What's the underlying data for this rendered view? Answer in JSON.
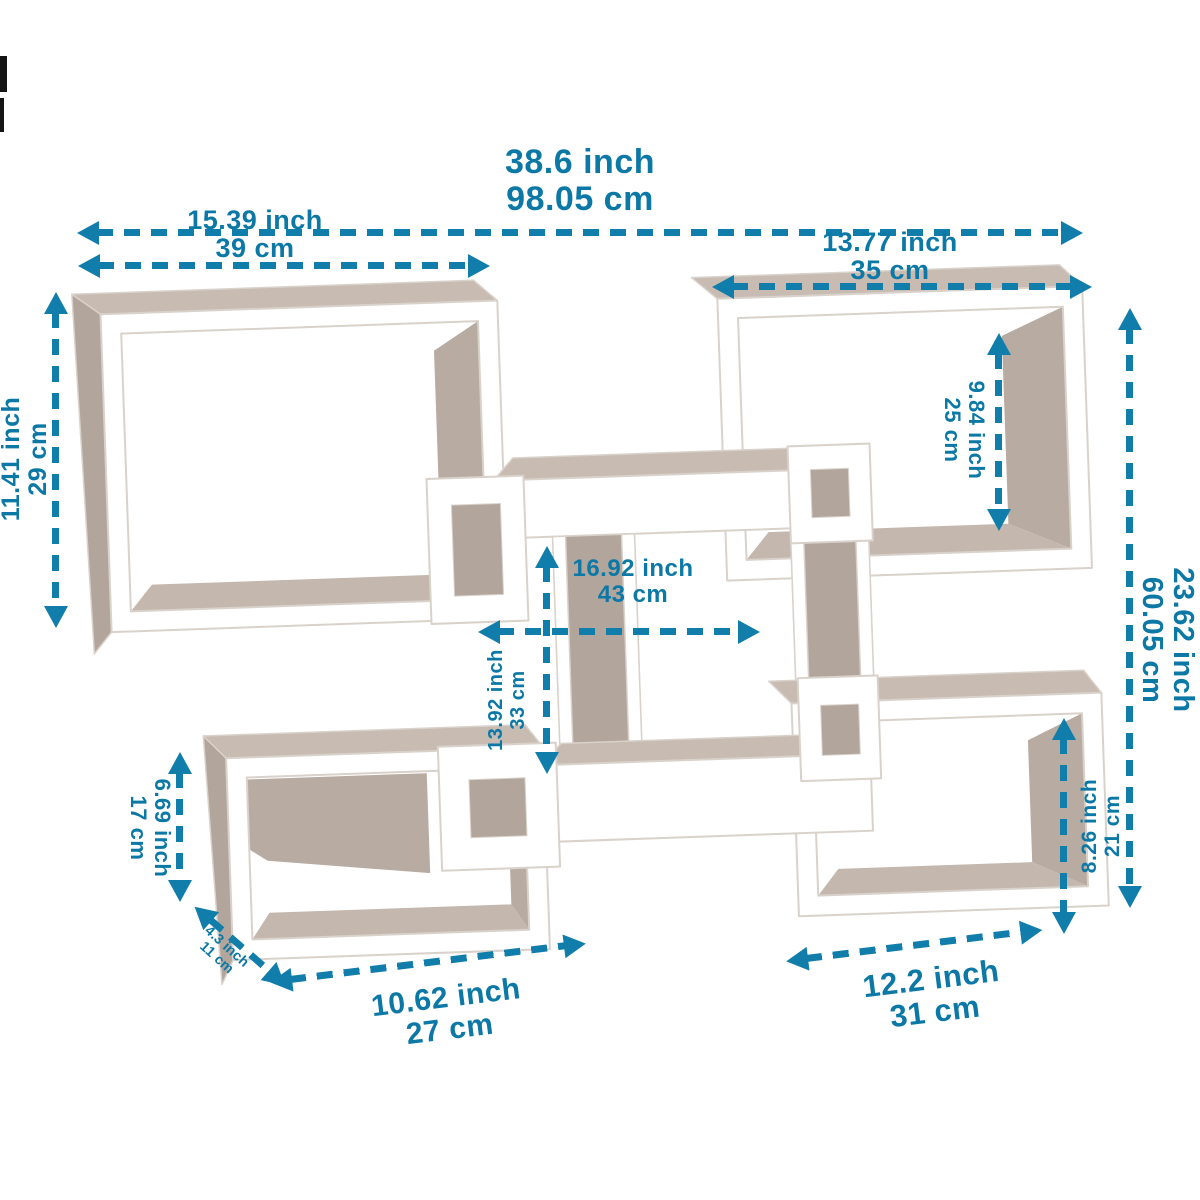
{
  "figure": {
    "title": "Intersecting cube wall shelf dimension diagram",
    "type": "product-dimension-diagram",
    "colors": {
      "accent": "#117dab",
      "accent_text": "#0c78a6",
      "frame": "#ffffff",
      "frame_stroke": "#d9d2cb",
      "panel": "#b2a59c",
      "panel_light": "#c7bbb2",
      "panel_wall": "#b8aba2",
      "panel_floor": "#c3b7ae",
      "background": "#ffffff"
    }
  },
  "dimensions": {
    "overall_width": {
      "inch": "38.6 inch",
      "cm": "98.05 cm"
    },
    "top_left_width": {
      "inch": "15.39 inch",
      "cm": "39 cm"
    },
    "top_right_width": {
      "inch": "13.77 inch",
      "cm": "35 cm"
    },
    "left_height": {
      "inch": "11.41 inch",
      "cm": "29 cm"
    },
    "top_right_inner_height": {
      "inch": "9.84 inch",
      "cm": "25 cm"
    },
    "overall_height": {
      "inch": "23.62 inch",
      "cm": "60.05 cm"
    },
    "middle_width": {
      "inch": "16.92 inch",
      "cm": "43 cm"
    },
    "middle_height": {
      "inch": "13.92 inch",
      "cm": "33 cm"
    },
    "bottom_left_height": {
      "inch": "6.69 inch",
      "cm": "17 cm"
    },
    "depth": {
      "inch": "4.3 inch",
      "cm": "11 cm"
    },
    "bottom_left_width": {
      "inch": "10.62 inch",
      "cm": "27 cm"
    },
    "bottom_right_width": {
      "inch": "12.2 inch",
      "cm": "31 cm"
    },
    "bottom_right_height": {
      "inch": "8.26 inch",
      "cm": "21 cm"
    }
  }
}
